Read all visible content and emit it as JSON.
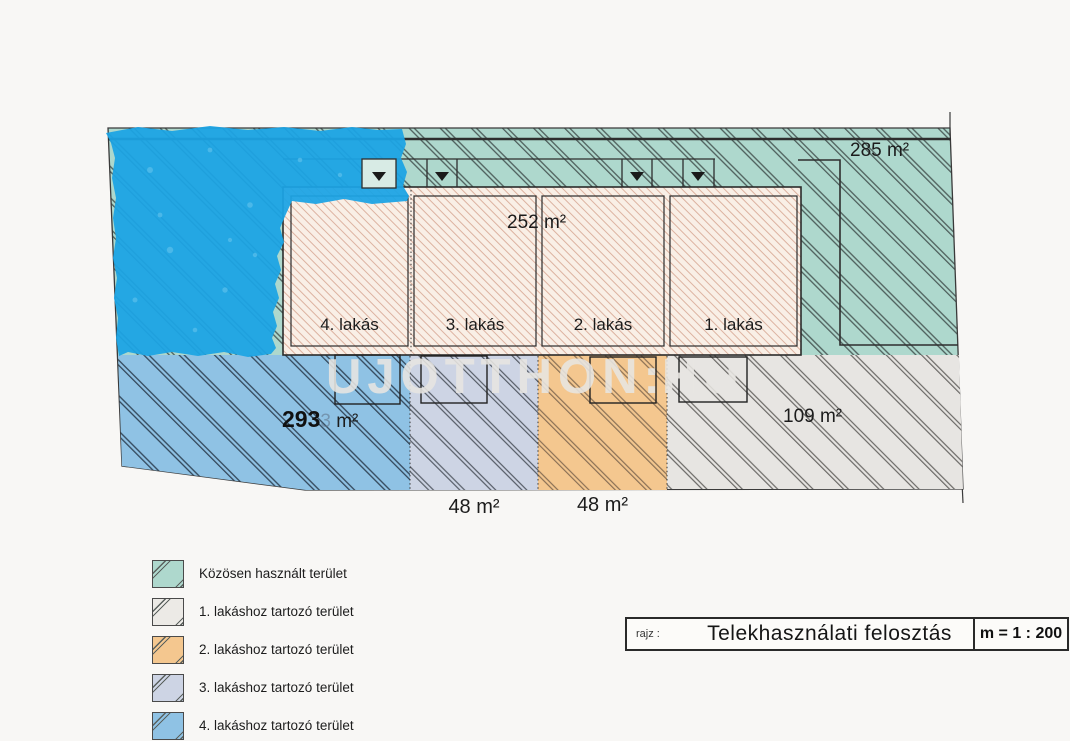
{
  "plan": {
    "areas": {
      "common": "285 m²",
      "building": "252 m²",
      "garden4_bold": "293",
      "garden4_ghost": "3",
      "garden4_unit": "m²",
      "garden3": "48 m²",
      "garden2": "48 m²",
      "garden1": "109 m²"
    },
    "units": [
      {
        "label": "4. lakás"
      },
      {
        "label": "3. lakás"
      },
      {
        "label": "2. lakás"
      },
      {
        "label": "1. lakás"
      }
    ],
    "colors": {
      "common_teal": "#aed8cd",
      "building_cream": "#f9efe6",
      "unit1_gray": "#e7e5e2",
      "unit2_orange": "#f4c78f",
      "unit3_lavender": "#cdd4e4",
      "unit4_blue": "#8fc2e4",
      "marker_blue": "#1ca4e4"
    }
  },
  "watermark": {
    "text_left": "UJOTTHON",
    "separator": ":",
    "text_right": "HU"
  },
  "legend": {
    "items": [
      {
        "label": "Közösen használt terület",
        "color": "#aed8cd"
      },
      {
        "label": "1. lakáshoz tartozó terület",
        "color": "#eceae6"
      },
      {
        "label": "2. lakáshoz tartozó terület",
        "color": "#f4c78f"
      },
      {
        "label": "3. lakáshoz tartozó terület",
        "color": "#cdd4e4"
      },
      {
        "label": "4. lakáshoz tartozó terület",
        "color": "#8fc2e4"
      }
    ]
  },
  "title_block": {
    "prefix": "rajz :",
    "title": "Telekhasználati felosztás",
    "scale": "m = 1 : 200"
  }
}
